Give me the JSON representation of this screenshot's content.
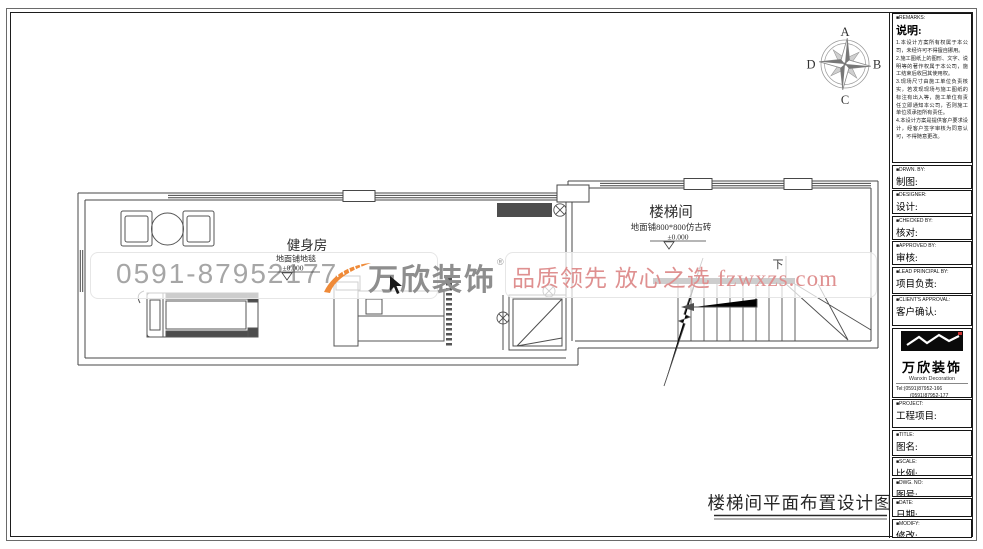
{
  "drawing": {
    "title": "楼梯间平面布置设计图",
    "compass": {
      "top": "A",
      "right": "B",
      "bottom": "C",
      "left": "D"
    },
    "rooms": [
      {
        "name": "健身房",
        "floor_note": "地面铺地毯",
        "level": "±0.000"
      },
      {
        "name": "楼梯间",
        "floor_note": "地面铺800*800仿古砖",
        "level": "±0.000"
      }
    ],
    "stair_label": "下"
  },
  "watermark": {
    "phone": "0591-87952177",
    "brand": "万欣装饰",
    "trademark": "®",
    "slogan": "品质领先 放心之选 fzwxzs.com",
    "colors": {
      "swoosh_orange": "#ef8a38",
      "slogan_pink": "#df9090",
      "phone_gray": "#a6a6a6"
    }
  },
  "title_block": {
    "remarks": {
      "en": "■REMARKS:",
      "zh": "说明:",
      "body": "1.本设计方案所有权属于本公司，未经许可不得擅自挪用。\n2.施工图纸上的图形、文字、说明等的著作权属于本公司，施工结束后收回其使用权。\n3.现场尺寸由施工单位负责核实，若发现现场与施工图纸的标注有出入等，施工单位有责任立即通知本公司，否则施工单位须承担所有责任。\n4.本设计方案是提供客户要求设计，经客户签字审核为同意认可，不得随意更改。"
    },
    "drwn_by": {
      "en": "■DRWN. BY:",
      "zh": "制图:"
    },
    "designer": {
      "en": "■DESIGNER:",
      "zh": "设计:"
    },
    "checked_by": {
      "en": "■CHECKED BY:",
      "zh": "核对:"
    },
    "approved_by": {
      "en": "■APPROVED BY:",
      "zh": "审核:"
    },
    "lead_principal": {
      "en": "■LEAD PRINCIPAL BY:",
      "zh": "项目负责:"
    },
    "client_approval": {
      "en": "■CLIENT'S APPROVAL:",
      "zh": "客户确认:"
    },
    "company": {
      "brand": "万欣装饰",
      "en": "Wanxin Decoration",
      "tel1": "Tel:(0591)87952-166",
      "tel2": "(0591)87952-177",
      "fax": "Fax:(0591)87952-198",
      "web": "Web:WWW.fzwxzs.com"
    },
    "project": {
      "en": "■PROJECT:",
      "zh": "工程项目:"
    },
    "title": {
      "en": "■TITLE:",
      "zh": "图名:"
    },
    "scale": {
      "en": "■SCALE:",
      "zh": "比例:"
    },
    "dwg_no": {
      "en": "■DWG. NO:",
      "zh": "图号:"
    },
    "date": {
      "en": "■DATE:",
      "zh": "日期:"
    },
    "modify": {
      "en": "■MODIFY:",
      "zh": "修改:"
    }
  }
}
